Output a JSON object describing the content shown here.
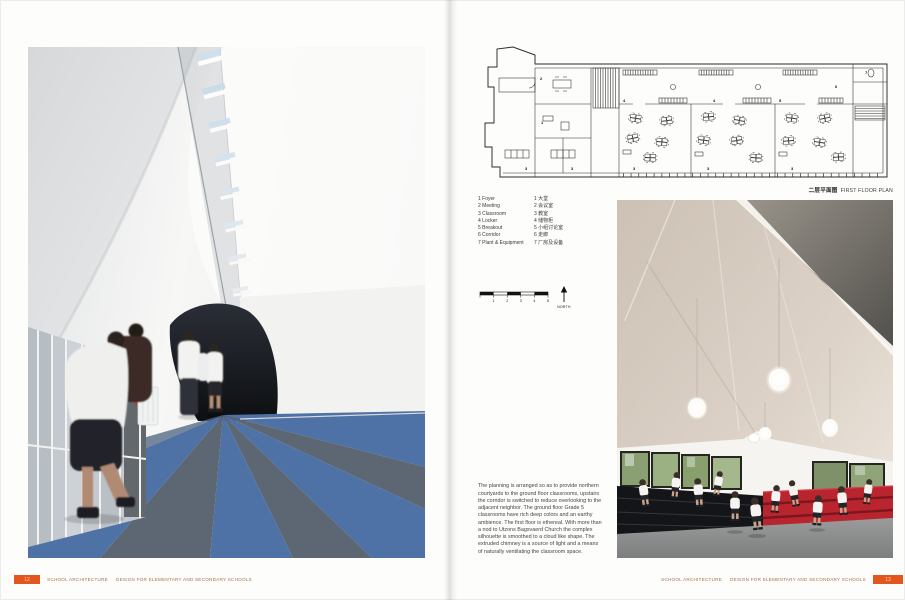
{
  "spread": {
    "left_page": {
      "photo": {
        "name": "corridor-photo",
        "description": "School corridor with striped blue carpet, sculpted white ceiling skylight and children walking"
      },
      "footer": {
        "page_number": "12",
        "series_title": "SCHOOL ARCHITECTURE",
        "book_title": "DESIGN FOR ELEMENTARY AND SECONDARY SCHOOLS"
      }
    },
    "right_page": {
      "plan": {
        "caption_cn": "二层平面图",
        "caption_en": "FIRST FLOOR PLAN",
        "room_marks": [
          "2",
          "1",
          "3",
          "3",
          "4",
          "3",
          "4",
          "3",
          "5",
          "3",
          "6",
          "7"
        ]
      },
      "legend": {
        "rows": [
          {
            "en": "1 Foyer",
            "cn": "1 大堂"
          },
          {
            "en": "2 Meeting",
            "cn": "2 会议室"
          },
          {
            "en": "3 Classroom",
            "cn": "3 教室"
          },
          {
            "en": "4 Locker",
            "cn": "4 储物柜"
          },
          {
            "en": "5 Breakout",
            "cn": "5 小组讨论室"
          },
          {
            "en": "6 Corridor",
            "cn": "6 走廊"
          },
          {
            "en": "7 Plant & Equipment",
            "cn": "7 厂房及设备"
          }
        ]
      },
      "scale_bar": {
        "ticks": [
          "1",
          "2",
          "3",
          "4",
          "5"
        ],
        "north_label": "NORTH"
      },
      "photo": {
        "name": "assembly-space-photo",
        "description": "Vaulted cloud-like ceiling with pendant lights over tiered black and red seating with children"
      },
      "body_text": "The planning is arranged so as to provide northern courtyards to the ground floor classrooms, upstairs the corridor is switched to reduce overlooking to the adjacent neighbor. The ground floor Grade 5 classrooms have rich deep colors and an earthy ambience. The first floor is ethereal. With more than a nod to Utzons Bagsvaerd Church the complex silhouette is smoothed to a cloud like shape. The extruded chimney is a source of light and a means of naturally ventilating the classroom space.",
      "footer": {
        "page_number": "13",
        "series_title": "SCHOOL ARCHITECTURE",
        "book_title": "DESIGN FOR ELEMENTARY AND SECONDARY SCHOOLS"
      }
    },
    "colors": {
      "accent_orange": "#e2571d",
      "carpet_blue": "#4e72a6",
      "carpet_slate": "#5d6773",
      "seat_red": "#b9252f",
      "seat_black": "#141519",
      "plan_line": "#2b2b2b"
    }
  }
}
